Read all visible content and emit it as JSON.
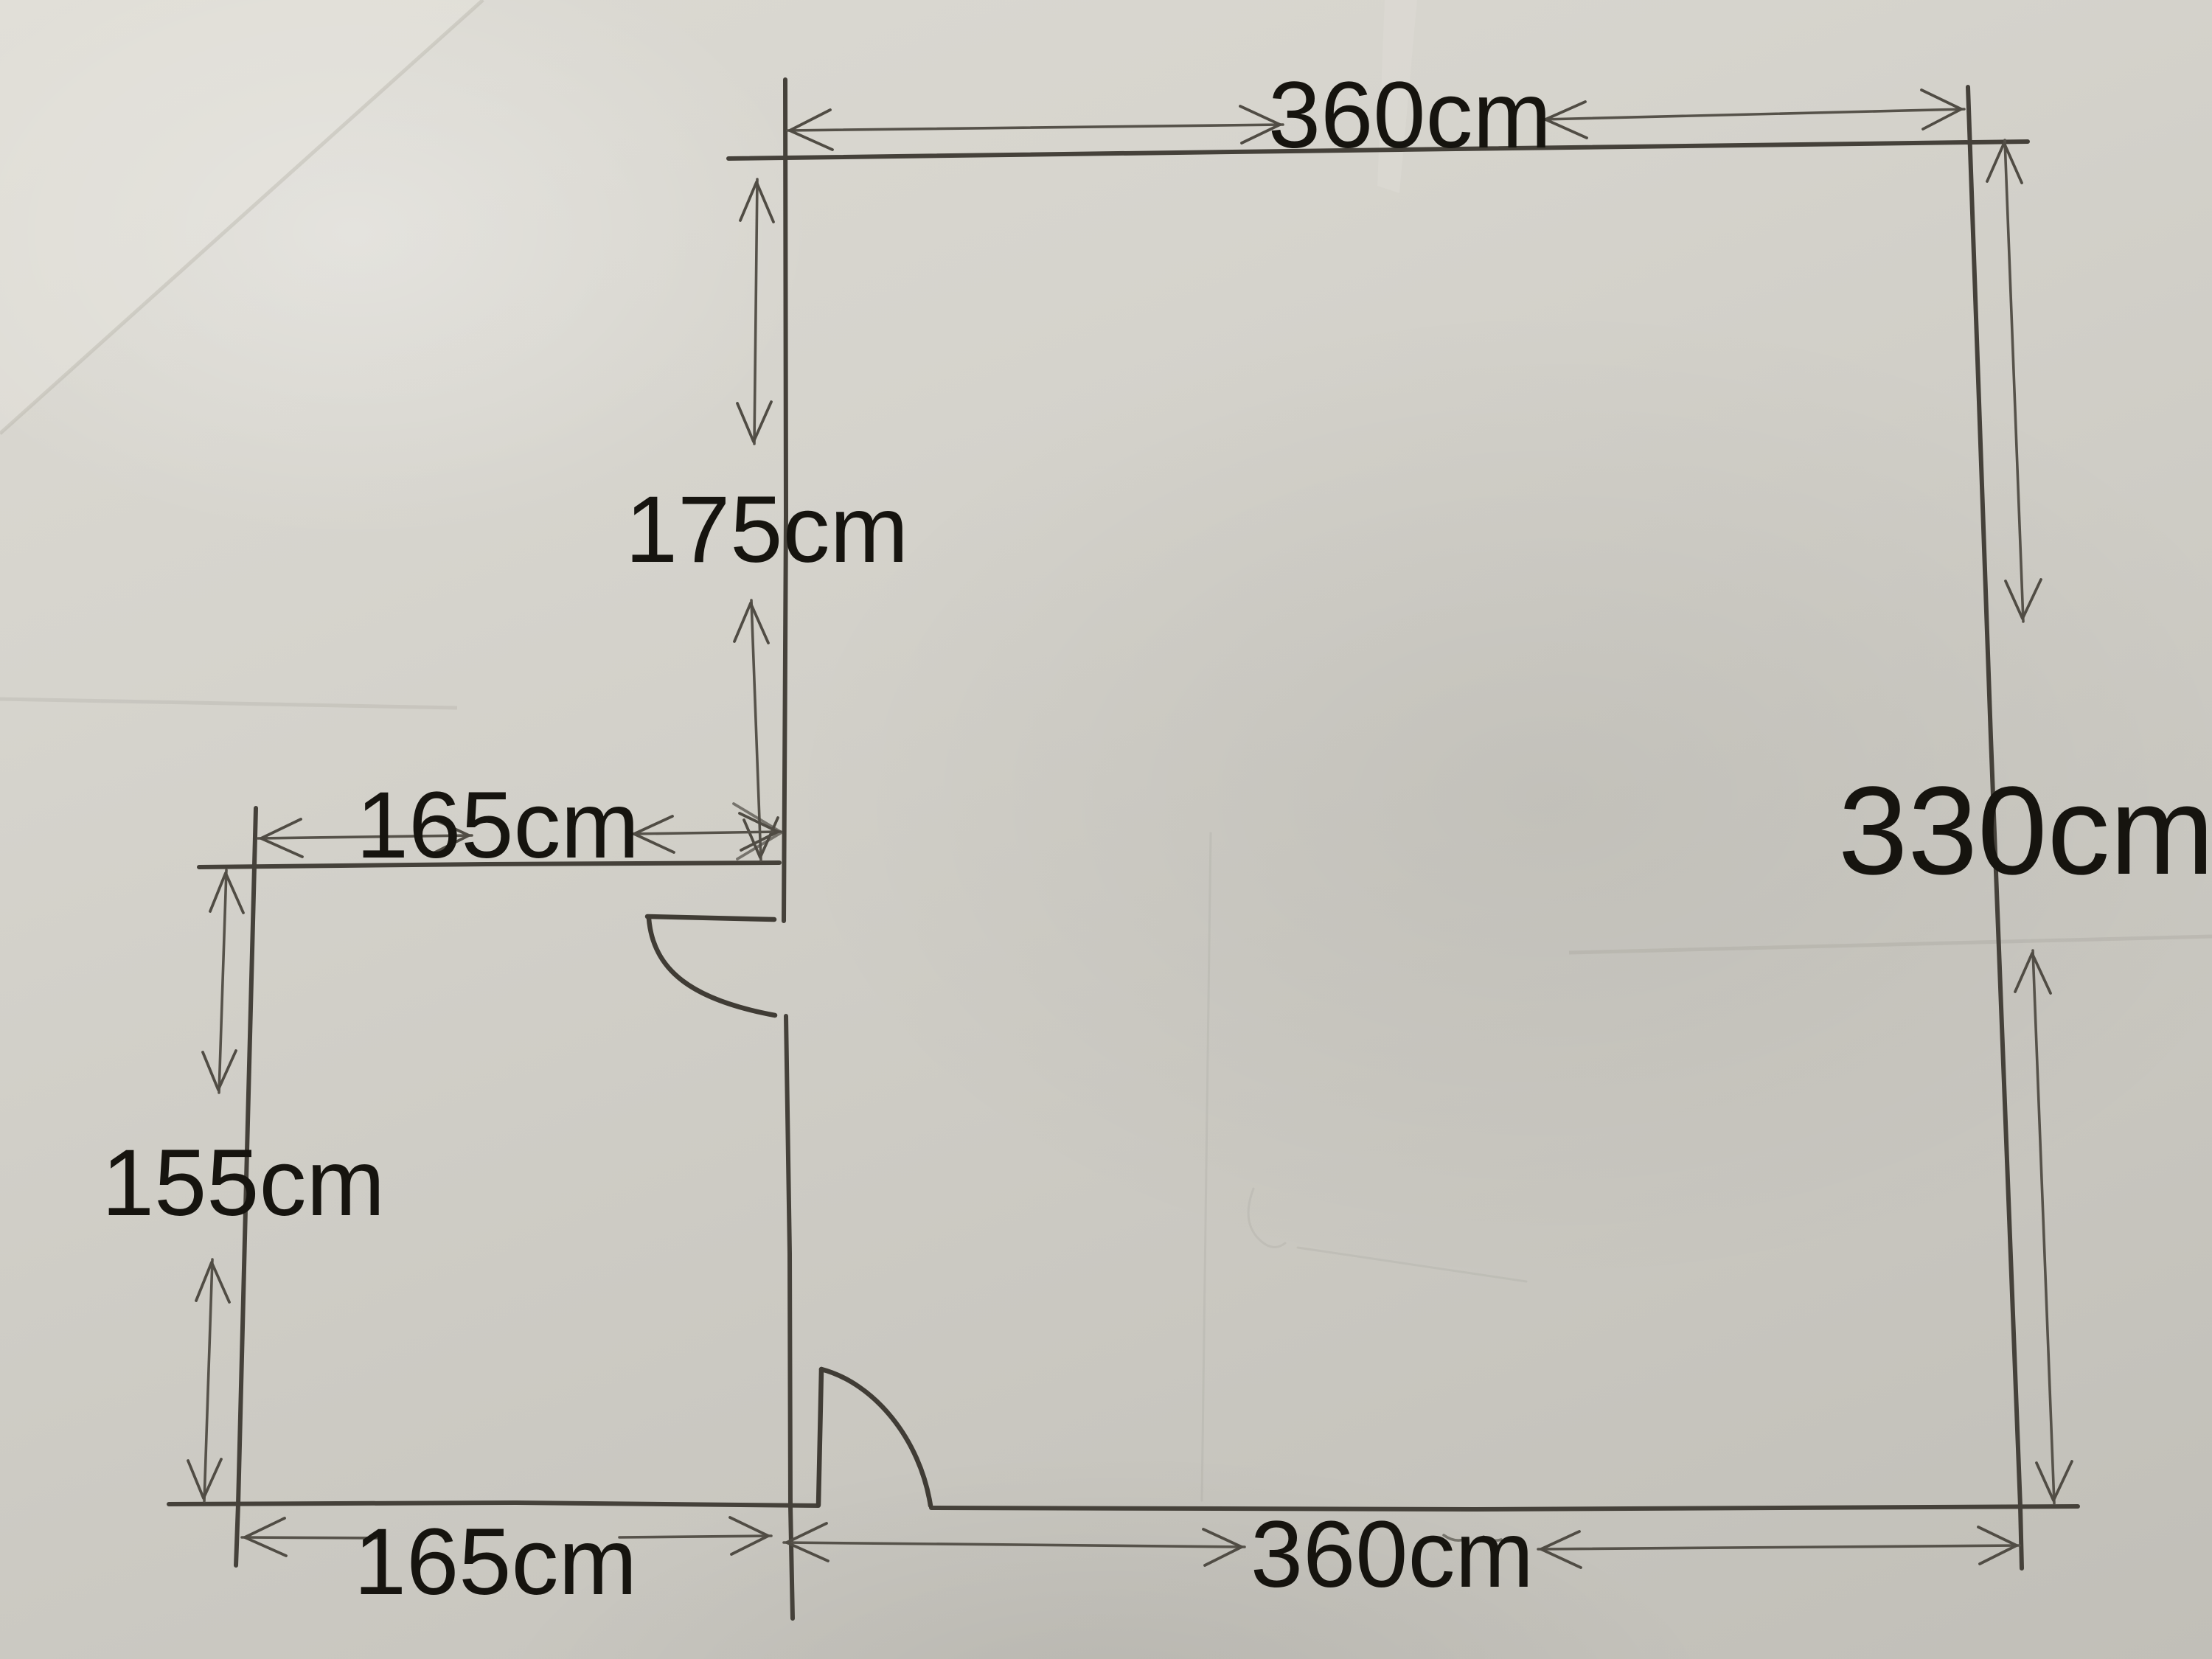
{
  "image": {
    "kind": "photo of hand-drawn floor plan sketch on paper",
    "unit": "cm"
  },
  "colors": {
    "paper_light": "#dcdad3",
    "paper_mid": "#d0cec7",
    "paper_dark": "#c1bfb8",
    "ink_walls": "#45413a",
    "ink_dimensions": "#56524a",
    "label_text": "#16140f"
  },
  "labels": {
    "top_width": "360cm",
    "upper_inner_height": "175cm",
    "inner_width": "165cm",
    "right_height": "330cm",
    "left_height": "155cm",
    "bottom_left_width": "165cm",
    "bottom_right_width": "360cm"
  },
  "floor_plan": {
    "rooms": [
      {
        "name": "main room",
        "width_cm": 360,
        "height_cm": 330
      },
      {
        "name": "side room (bottom-left)",
        "width_cm": 165,
        "height_cm": 155
      }
    ],
    "wall_segment_above_side_room_cm": 175,
    "door_count": 2,
    "doors": [
      {
        "location": "shared wall between side room and main room",
        "swings_into": "side room"
      },
      {
        "location": "bottom wall of main room",
        "swings_into": "main room"
      }
    ]
  }
}
